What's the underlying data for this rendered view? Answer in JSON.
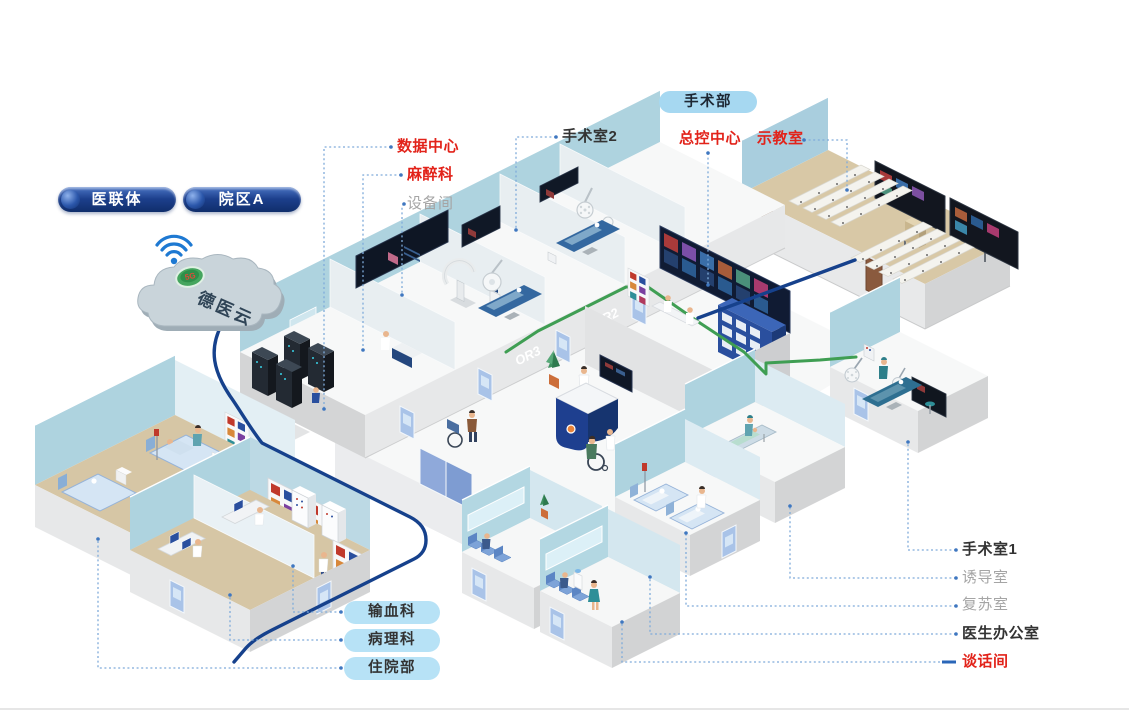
{
  "title": "智慧手术部 院区isometric示意图",
  "colors": {
    "accent_navy": "#16418c",
    "cable_green": "#3f9e53",
    "label_red": "#e2231a",
    "label_gray": "#a5a5a5",
    "label_dark": "#333333",
    "leader_blue": "#7fabda",
    "pill_navy": "#1c3f8c",
    "pill_light_blue": "#a6d8f1",
    "pill_sky_blue": "#b7e2f6",
    "wall_blue": "#aed3df",
    "floor_tan": "#d6c6a5"
  },
  "pills": {
    "medical_alliance": "医联体",
    "campus_a": "院区A",
    "surgery_department": "手术部",
    "blood_transfusion": "输血科",
    "pathology": "病理科",
    "inpatient": "住院部"
  },
  "cloud": {
    "name": "德医云",
    "badge": "5G"
  },
  "callouts": {
    "data_center": "数据中心",
    "anesthesiology": "麻醉科",
    "equipment_room": "设备间",
    "operating_room_2": "手术室2",
    "master_control_center": "总控中心",
    "demonstration_room": "示教室",
    "operating_room_1": "手术室1",
    "induction_room": "诱导室",
    "recovery_room": "复苏室",
    "doctors_office": "医生办公室",
    "talk_room": "谈话间"
  },
  "wall_labels": {
    "or3": "OR3",
    "or2": "OR2"
  }
}
